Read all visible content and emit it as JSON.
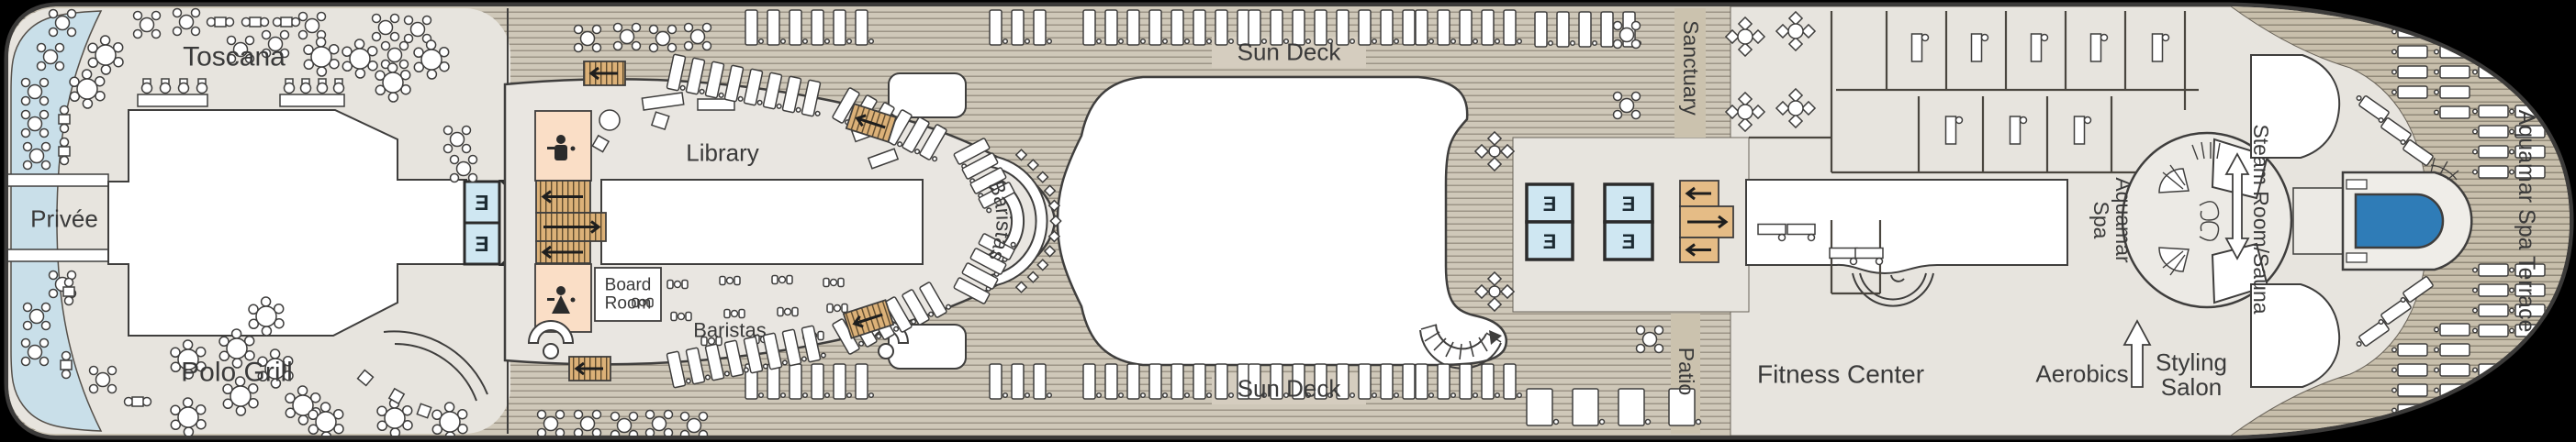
{
  "deck_plan": {
    "title_labels": {
      "toscana": "Toscana",
      "privee": "Privée",
      "polo_grill": "Polo Grill",
      "library": "Library",
      "board_room": "Board Room",
      "baristas": "Baristas",
      "sun_deck": "Sun Deck",
      "sanctuary": "Sanctuary",
      "patio": "Patio",
      "fitness_center": "Fitness Center",
      "aerobics": "Aerobics",
      "styling_salon": "Styling Salon",
      "aquamar_spa": "Aquamar Spa",
      "steam_room_sauna": "Steam Room/Sauna",
      "aquamar_spa_terrace": "Aquamar Spa Terrace"
    },
    "icons": {
      "elevator_letter": "E",
      "mens_restroom": "mens-restroom-icon",
      "womens_restroom": "womens-restroom-icon",
      "stairs": "stairs-icon",
      "pool": "pool-icon",
      "lounger": "lounger-icon",
      "dining_table": "dining-table-icon"
    },
    "colors": {
      "hull_outline": "#3b3a39",
      "deck_planks": "#cfc8b9",
      "deck_planks_dark": "#c8bfac",
      "interior_floor": "#e7e4de",
      "room_white": "#ffffff",
      "stern_terrace_blue": "#c9dfe9",
      "elevator_blue": "#cfe7f2",
      "stairs_tan": "#ddb57e",
      "restroom_peach": "#fadec6",
      "pool_blue": "#2f7cb7",
      "label_text": "#3a3a3a",
      "sun_deck_label_box": "#d5cdbf"
    }
  }
}
